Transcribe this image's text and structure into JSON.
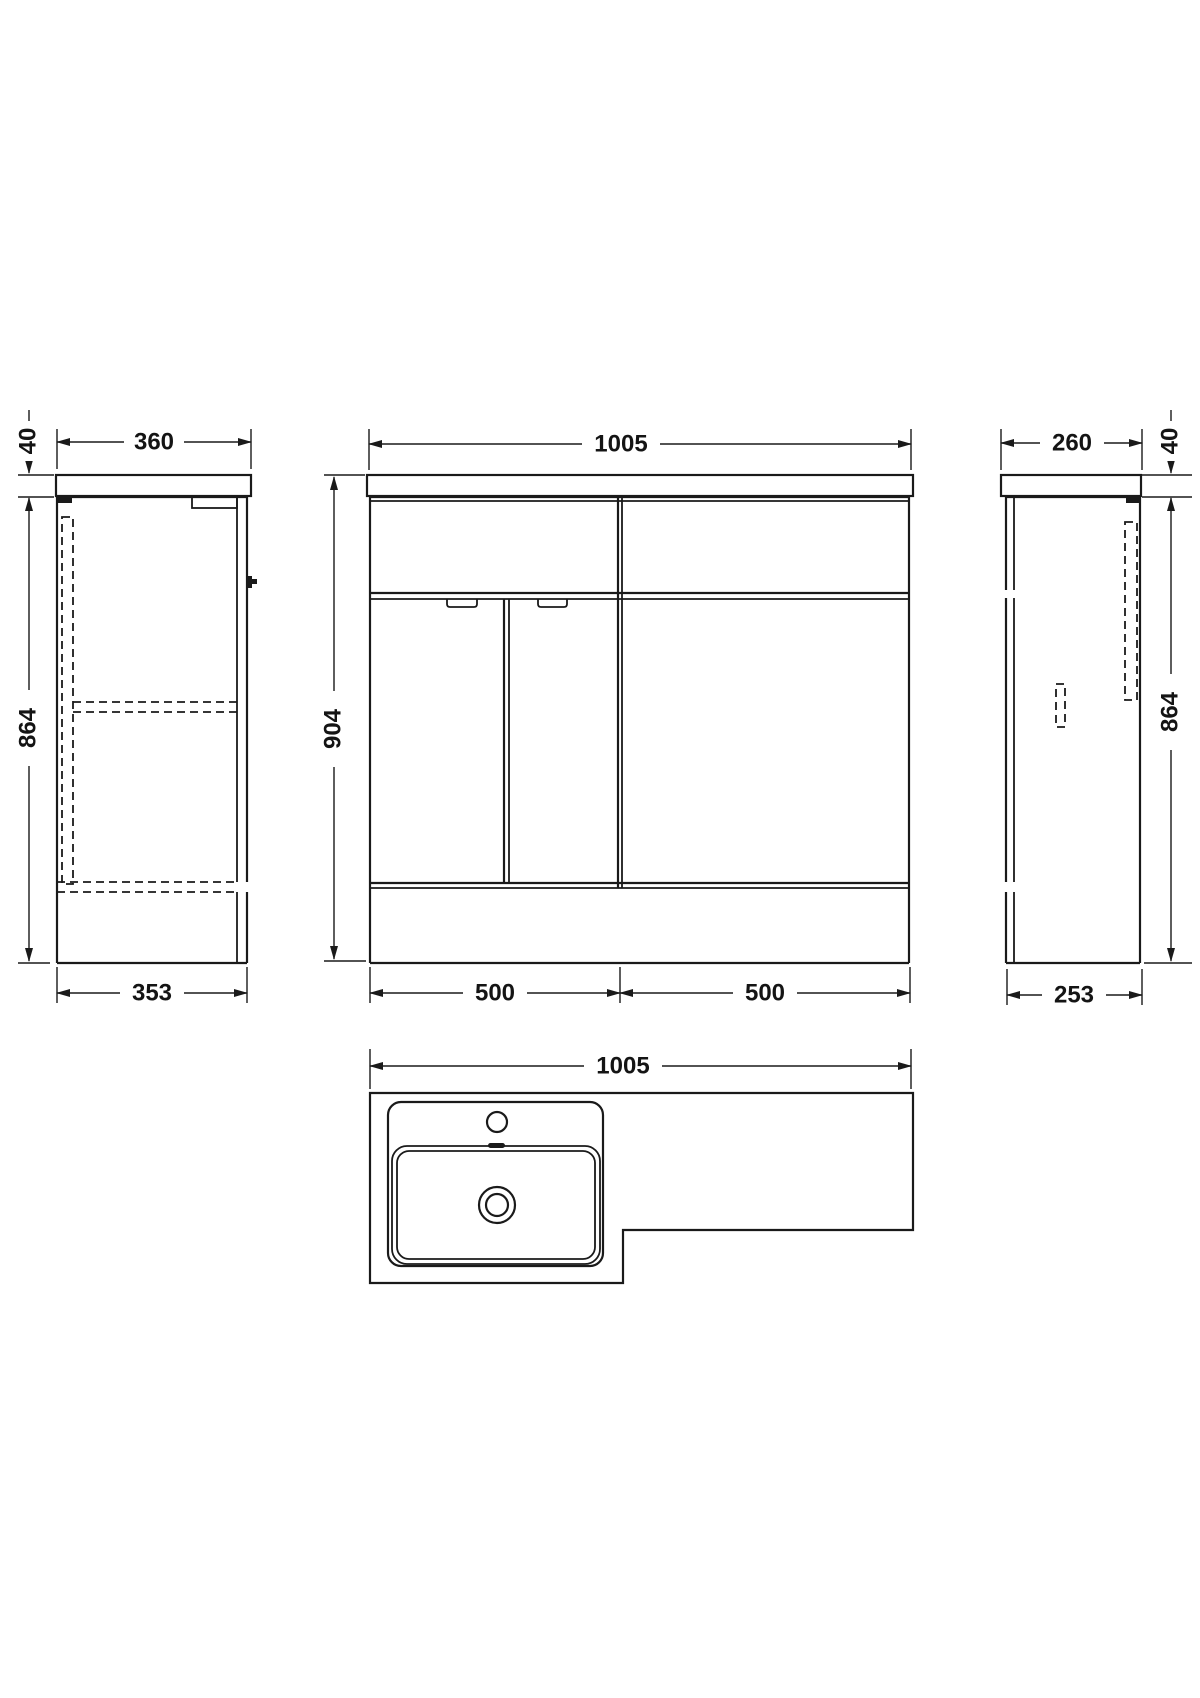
{
  "page": {
    "background": "#ffffff"
  },
  "drawing": {
    "line_color": "#1a1a1a",
    "views": {
      "left_side": {
        "name": "Left side elevation",
        "dims": {
          "top_width": "360",
          "counter_thickness": "40",
          "body_height": "864",
          "base_depth": "353"
        }
      },
      "front": {
        "name": "Front elevation",
        "dims": {
          "overall_width": "1005",
          "overall_height": "904",
          "left_bay_width": "500",
          "right_bay_width": "500"
        }
      },
      "right_side": {
        "name": "Right side elevation",
        "dims": {
          "top_width": "260",
          "counter_thickness": "40",
          "body_height": "864",
          "base_depth": "253"
        }
      },
      "plan": {
        "name": "Plan view",
        "dims": {
          "overall_width": "1005"
        }
      }
    }
  }
}
